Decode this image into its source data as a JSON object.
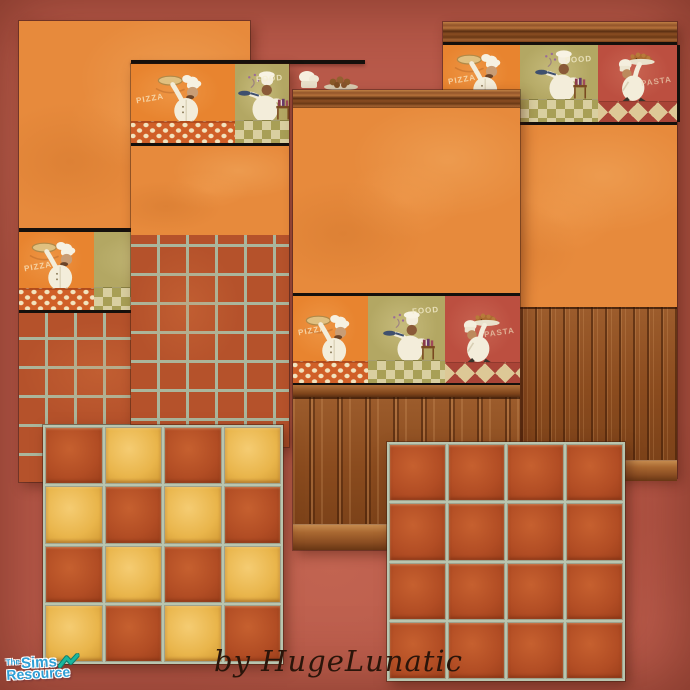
{
  "credit": {
    "text": "by HugeLunatic"
  },
  "logo": {
    "the": "The",
    "sims": "Sims",
    "resource": "Resource"
  },
  "words": {
    "pizza": "PIZZA",
    "food": "FOOD",
    "pasta": "PASTA"
  },
  "colors": {
    "background": "#b95a4a",
    "orange_wall": "#e78a3c",
    "border_orange": "#e8842f",
    "border_olive": "#b3a763",
    "border_red": "#bc4f40",
    "terracotta_tile": "#b5522b",
    "gold_tile": "#eebb55",
    "grout": "#b9c5af",
    "wood": "#8d4e21",
    "edge_line": "#15100c",
    "logo_blue": "#2f9fd6",
    "logo_teal": "#19b79e",
    "credit_ink": "#2a150a"
  },
  "borders": {
    "a": {
      "sections": [
        {
          "type": "pizza",
          "flex": 75
        },
        {
          "type": "cook",
          "flex": 156
        }
      ]
    },
    "b": {
      "sections": [
        {
          "type": "pizza",
          "flex": 104
        },
        {
          "type": "cook",
          "flex": 54
        }
      ]
    },
    "c": {
      "sections": [
        {
          "type": "pizza",
          "flex": 75
        },
        {
          "type": "cook",
          "flex": 77
        },
        {
          "type": "pie",
          "flex": 75
        }
      ]
    },
    "d": {
      "sections": [
        {
          "type": "pizza",
          "flex": 77
        },
        {
          "type": "cook",
          "flex": 78
        },
        {
          "type": "pie",
          "flex": 79
        }
      ]
    }
  },
  "floors": {
    "checker": {
      "rows": 4,
      "cols": 4,
      "pattern": [
        [
          "terracotta",
          "gold",
          "terracotta",
          "gold"
        ],
        [
          "gold",
          "terracotta",
          "gold",
          "terracotta"
        ],
        [
          "terracotta",
          "gold",
          "terracotta",
          "gold"
        ],
        [
          "gold",
          "terracotta",
          "gold",
          "terracotta"
        ]
      ]
    },
    "terracotta": {
      "rows": 4,
      "cols": 4,
      "pattern": [
        [
          "terracotta",
          "terracotta",
          "terracotta",
          "terracotta"
        ],
        [
          "terracotta",
          "terracotta",
          "terracotta",
          "terracotta"
        ],
        [
          "terracotta",
          "terracotta",
          "terracotta",
          "terracotta"
        ],
        [
          "terracotta",
          "terracotta",
          "terracotta",
          "terracotta"
        ]
      ]
    }
  }
}
